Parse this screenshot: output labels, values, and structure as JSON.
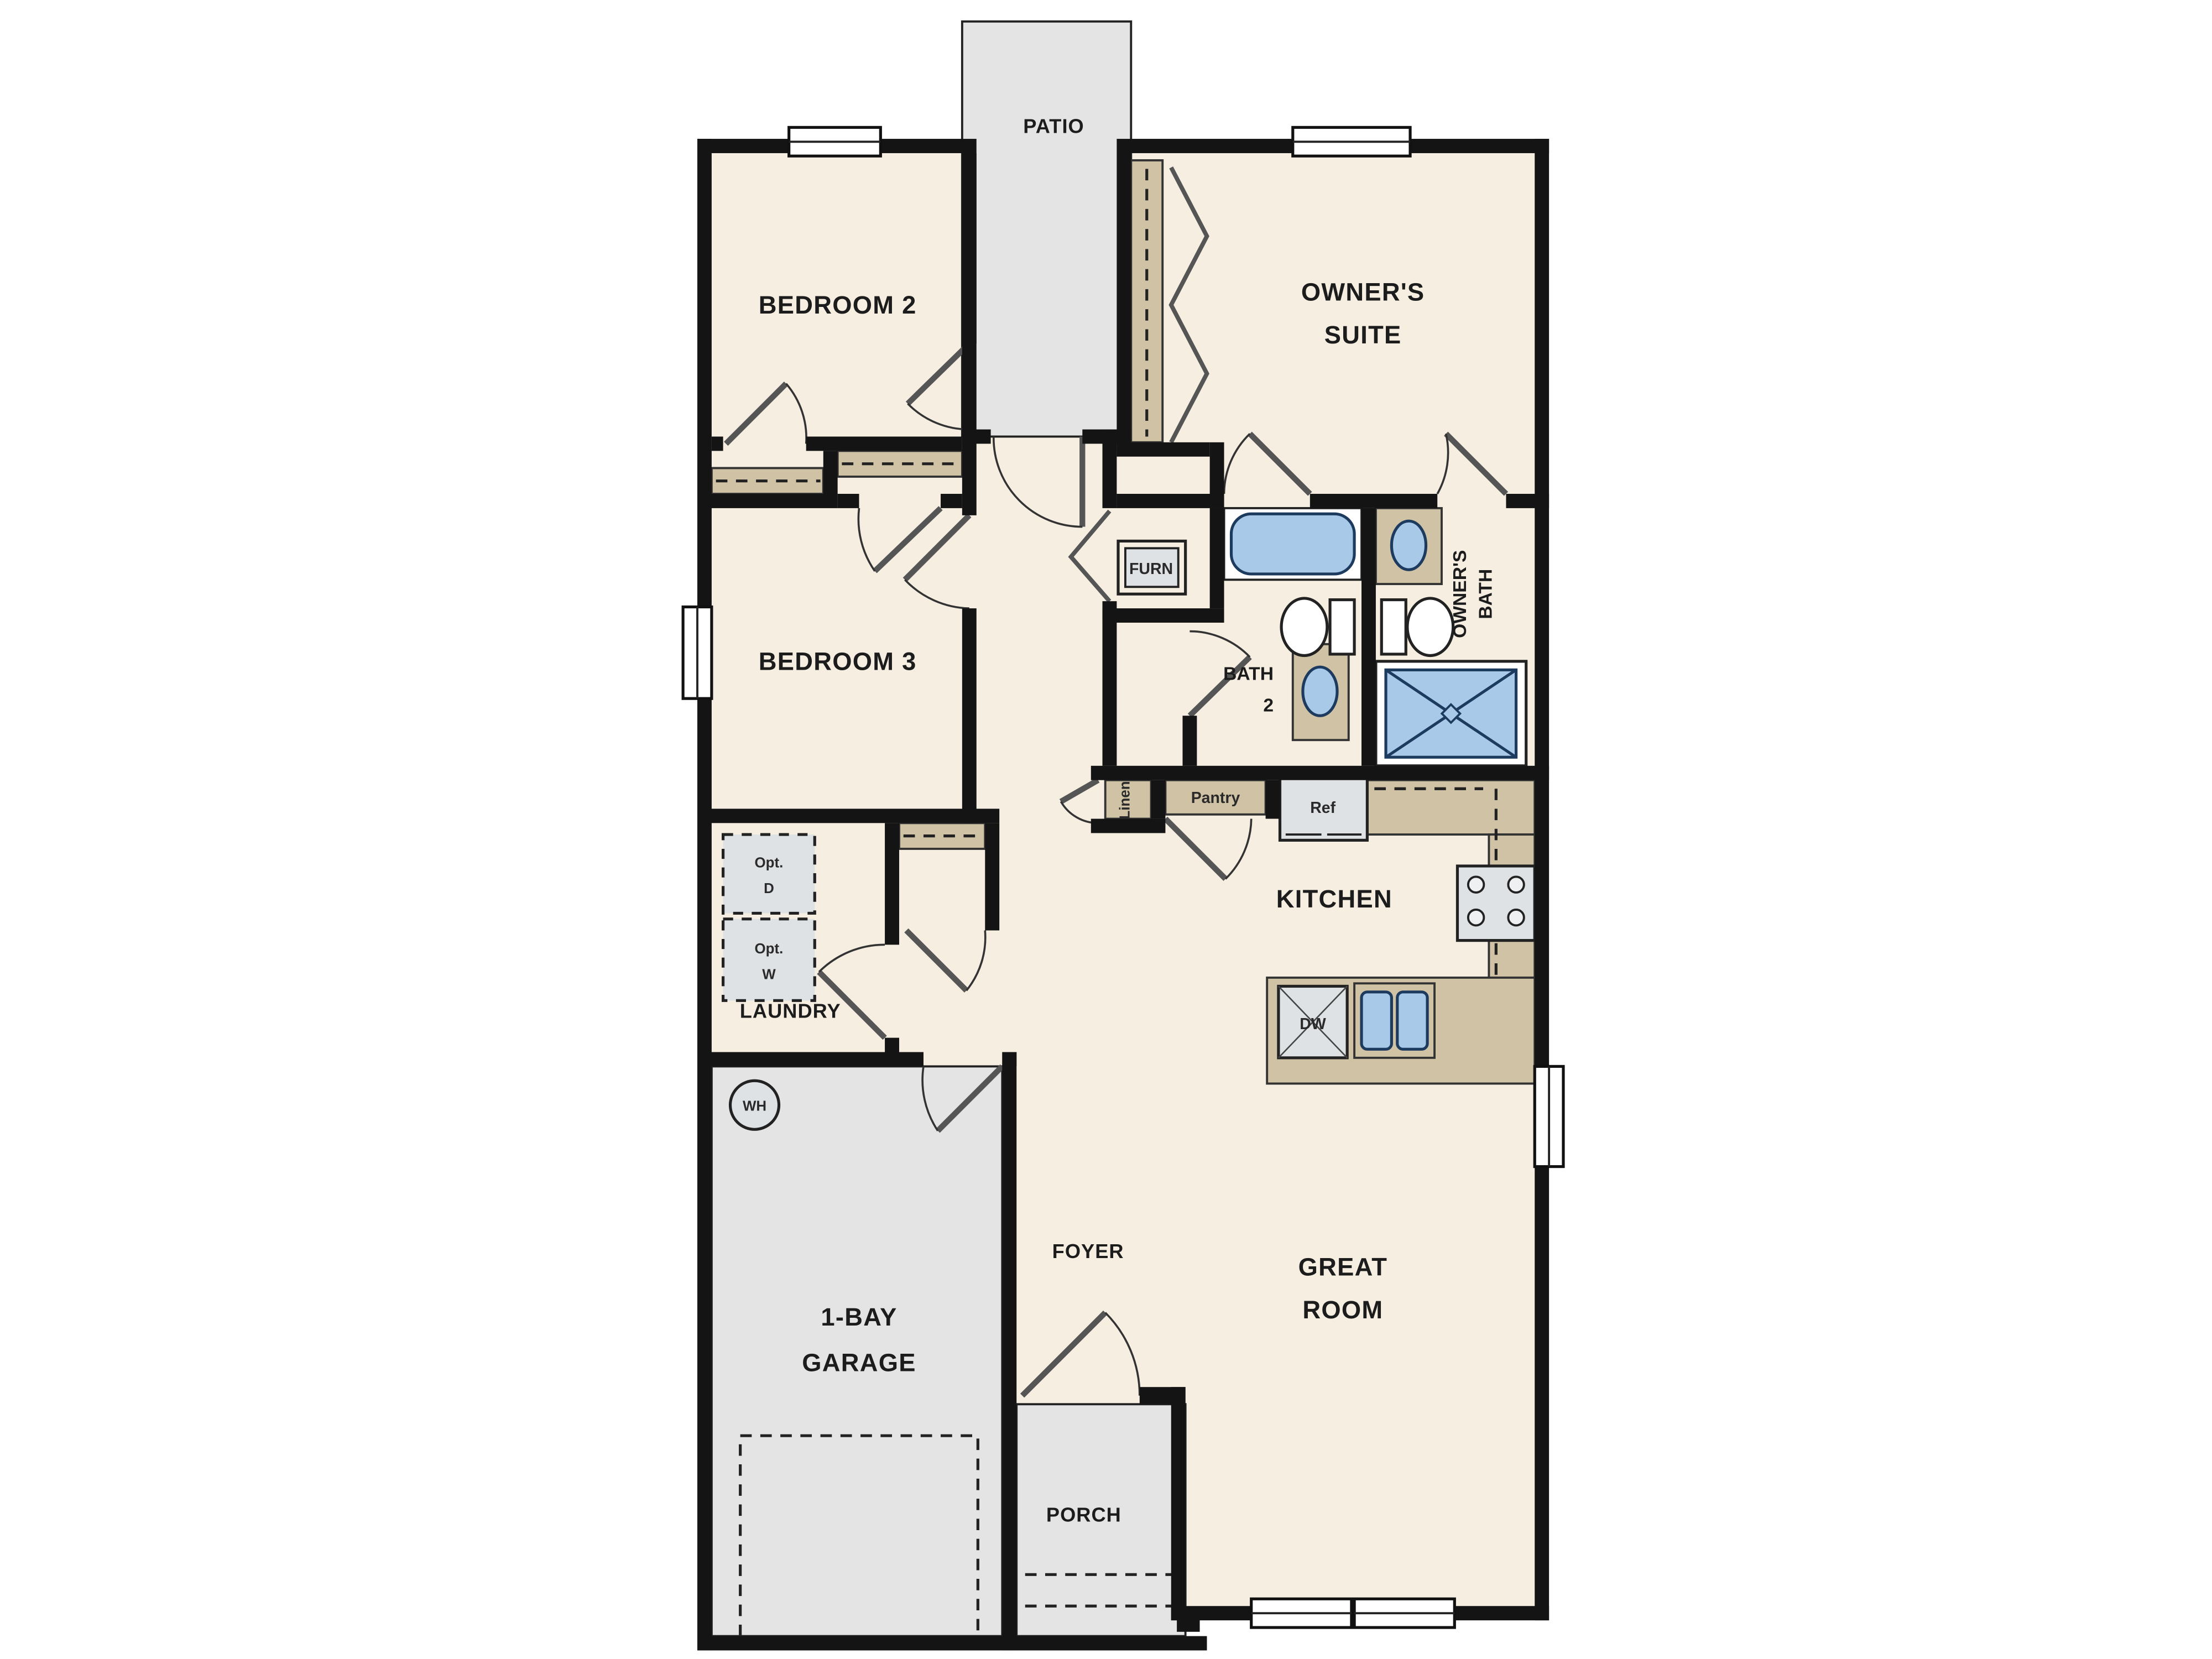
{
  "title": "Single-story floor plan",
  "colors": {
    "wall": "#141414",
    "floor_cream": "#f5eee1",
    "outdoor_gray": "#e4e4e4",
    "cabinet_tan": "#cfc2a5",
    "fixture_blue": "#a9c9e9",
    "appliance_gray": "#dfe2e4"
  },
  "labels": {
    "patio": "PATIO",
    "bedroom2": "BEDROOM 2",
    "owners_suite_1": "OWNER'S",
    "owners_suite_2": "SUITE",
    "bedroom3": "BEDROOM 3",
    "furn": "FURN",
    "bath2_1": "BATH",
    "bath2_2": "2",
    "owners_bath_1": "OWNER'S",
    "owners_bath_2": "BATH",
    "linen": "Linen",
    "pantry": "Pantry",
    "ref": "Ref",
    "kitchen": "KITCHEN",
    "laundry": "LAUNDRY",
    "opt_d_1": "Opt.",
    "opt_d_2": "D",
    "opt_w_1": "Opt.",
    "opt_w_2": "W",
    "wh": "WH",
    "garage_1": "1-BAY",
    "garage_2": "GARAGE",
    "foyer": "FOYER",
    "great_room_1": "GREAT",
    "great_room_2": "ROOM",
    "porch": "PORCH",
    "dw": "DW"
  }
}
